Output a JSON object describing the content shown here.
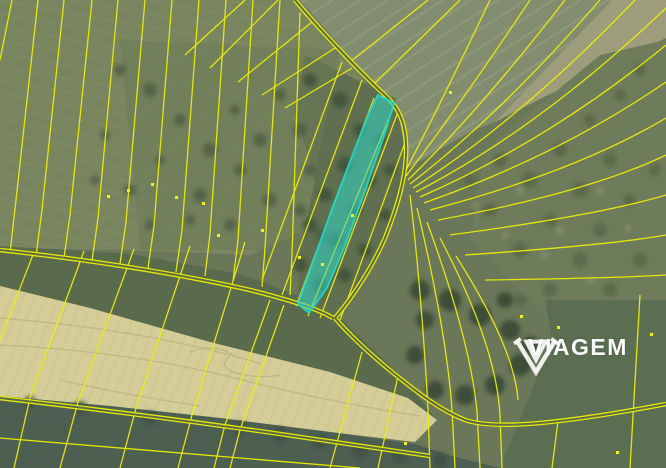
{
  "watermark": {
    "brand": "VIAGEM",
    "icon": "gem-diamond-icon"
  },
  "legend_colors": {
    "parcel_line": "#edf005",
    "highlight_fill": "#2fd7c9",
    "highlight_stroke": "#1fd6c6",
    "marker_dot": "#f4f400"
  }
}
